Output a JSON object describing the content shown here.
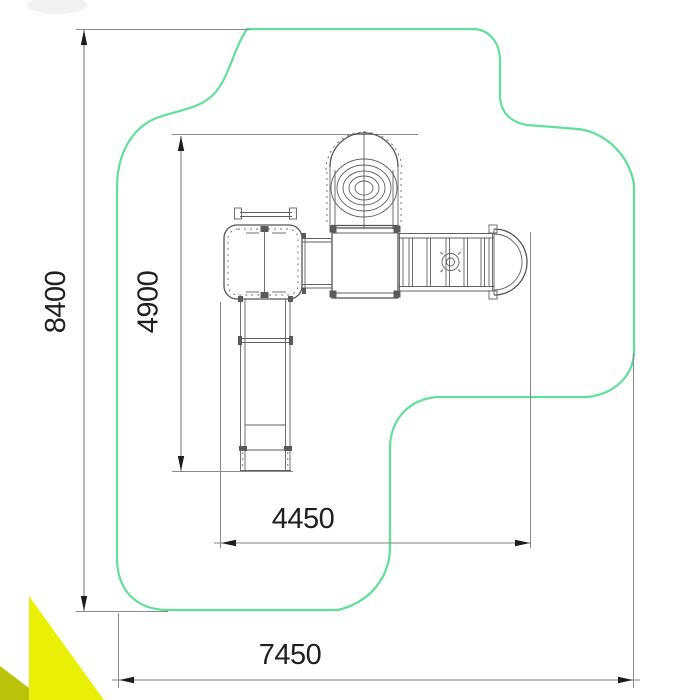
{
  "drawing": {
    "type": "playground-equipment-plan-view",
    "dimensions": {
      "overall_height": "8400",
      "equipment_height": "4900",
      "equipment_width": "4450",
      "overall_width": "7450"
    },
    "colors": {
      "safety_zone_outline": "#5fe098",
      "corner_ribbon": "#eaf005",
      "corner_ribbon_shade": "#b9c409",
      "equipment_lines": "#555555",
      "dimension_lines": "#7f7f7f",
      "dimension_text": "#1f1f1f",
      "background": "#ffffff"
    }
  }
}
